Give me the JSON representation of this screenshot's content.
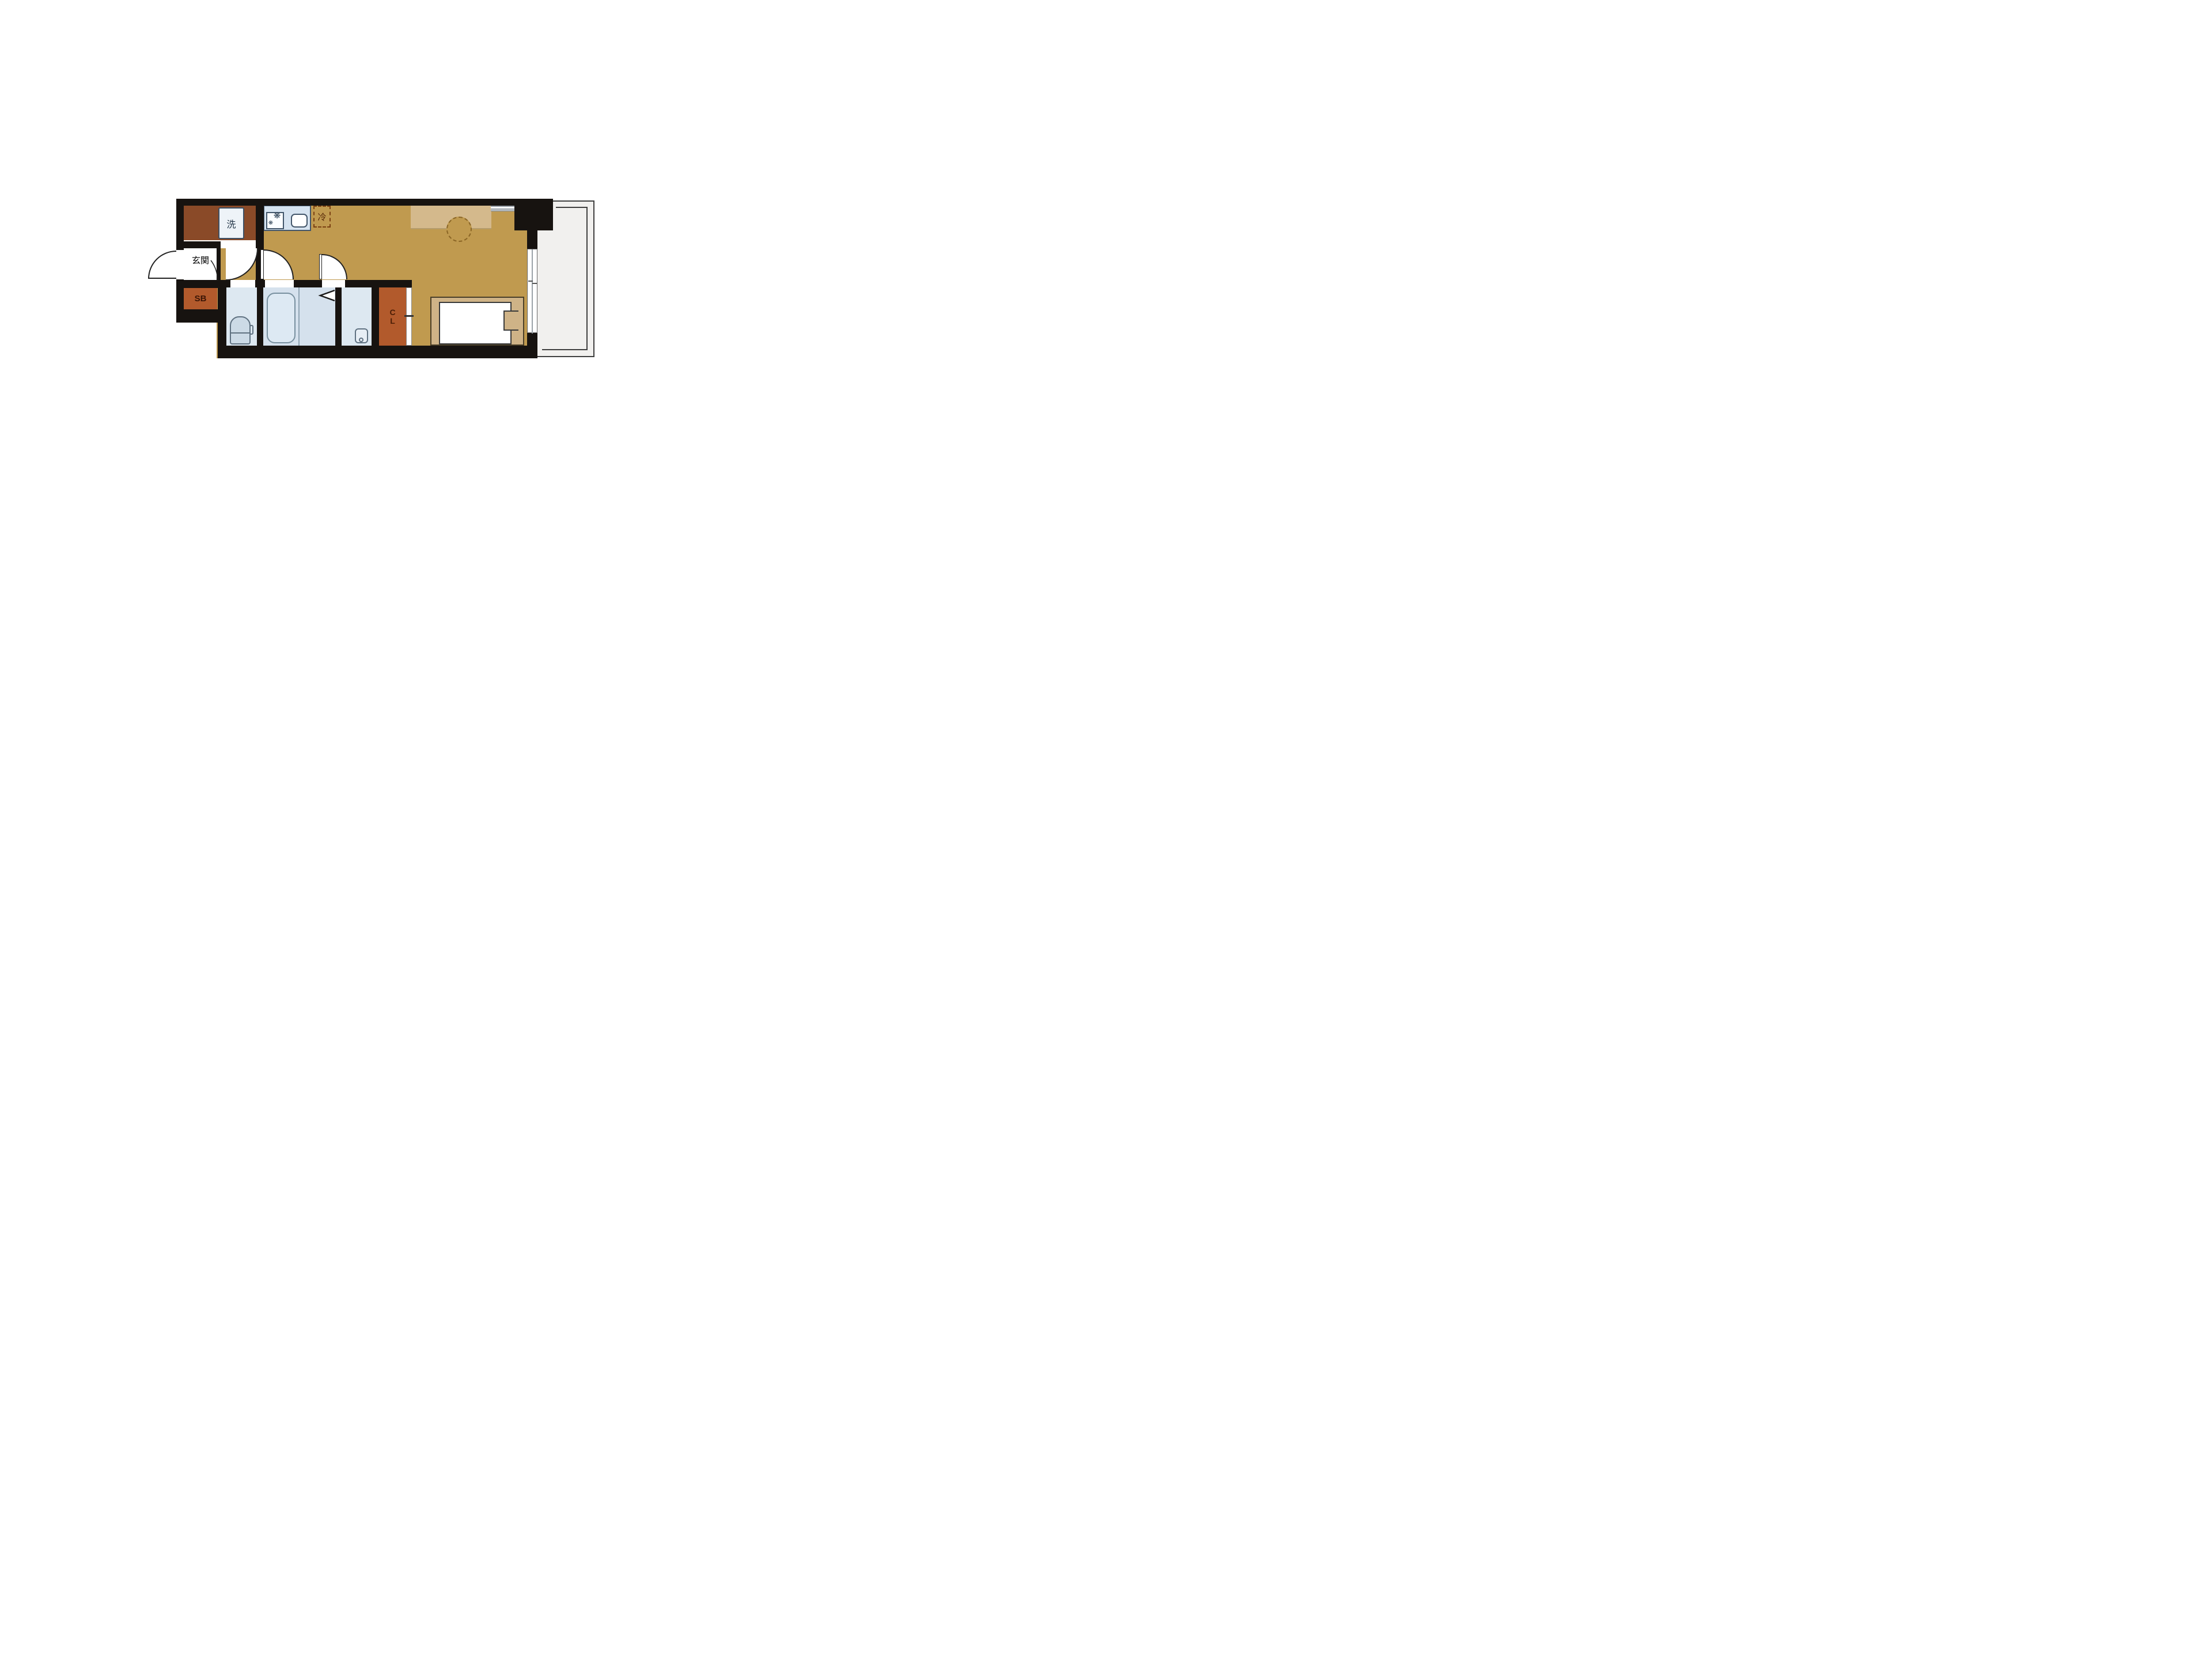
{
  "title": "1K apartment floor plan",
  "rooms": {
    "entrance_label": "玄関",
    "shoe_box_label": "SB",
    "closet_letters": [
      "C",
      "L"
    ],
    "washer_label": "洗",
    "fridge_label": "冷"
  },
  "fixtures": {
    "washer": "washing-machine-pan",
    "stove_burner_icon": "❋",
    "stove_burner_icon_small": "❋",
    "sink": "kitchen-sink",
    "fridge": "refrigerator-space",
    "toilet": "toilet",
    "bathtub": "bathtub",
    "basin": "wash-basin",
    "bed": "bed",
    "counter_desk": "counter-desk",
    "folding_door": "folding-door",
    "balcony": "balcony"
  },
  "colors": {
    "wall": "#171310",
    "ochre": "#c09a4f",
    "brown": "#8a4a28",
    "orange": "#b25a2c",
    "bath_blue": "#d5e1ed",
    "light_blue": "#dde8f1",
    "counter_blue": "#d6e3f0",
    "tan": "#d4b98c",
    "bed_tan": "#cfb387",
    "balcony_gray": "#f1f0ee",
    "fixture_stroke": "#43566a",
    "fridge_dash": "#7a4012"
  }
}
